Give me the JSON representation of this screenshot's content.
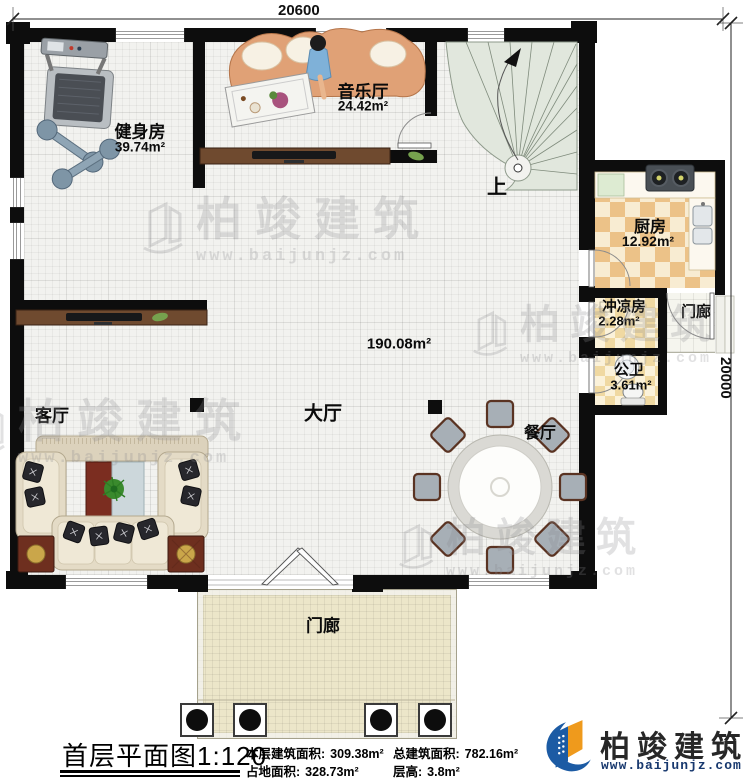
{
  "dimensions": {
    "width_label": "20600",
    "height_label": "20000"
  },
  "rooms": {
    "gym": {
      "label": "健身房",
      "area": "39.74m²"
    },
    "music": {
      "label": "音乐厅",
      "area": "24.42m²"
    },
    "stairs": {
      "label": "上"
    },
    "kitchen": {
      "label": "厨房",
      "area": "12.92m²"
    },
    "shower": {
      "label": "冲凉房",
      "area": "2.28m²"
    },
    "side_porch": {
      "label": "门廊"
    },
    "toilet": {
      "label": "公卫",
      "area": "3.61m²"
    },
    "hall": {
      "label": "大厅",
      "area": "190.08m²"
    },
    "living": {
      "label": "客厅"
    },
    "dining": {
      "label": "餐厅"
    },
    "porch": {
      "label": "门廊"
    }
  },
  "footer": {
    "title": "首层平面图",
    "scale": "1:120",
    "stats": [
      {
        "label": "本层建筑面积:",
        "value": "309.38m²"
      },
      {
        "label": "总建筑面积:",
        "value": "782.16m²"
      },
      {
        "label": "占地面积:",
        "value": "328.73m²"
      },
      {
        "label": "层高:",
        "value": "3.8m²"
      }
    ]
  },
  "brand": {
    "name": "柏竣建筑",
    "url": "www.baijunjz.com"
  },
  "watermark": {
    "name": "柏竣建筑",
    "url": "www.baijunjz.com"
  },
  "colors": {
    "wall": "#0d0d0d",
    "kitchen_tile": "#ecc288",
    "bath_tile": "#f0d9a2",
    "stair": "#e1e7dd",
    "brand_blue": "#1c5ba4",
    "brand_orange": "#ef9a1c"
  }
}
